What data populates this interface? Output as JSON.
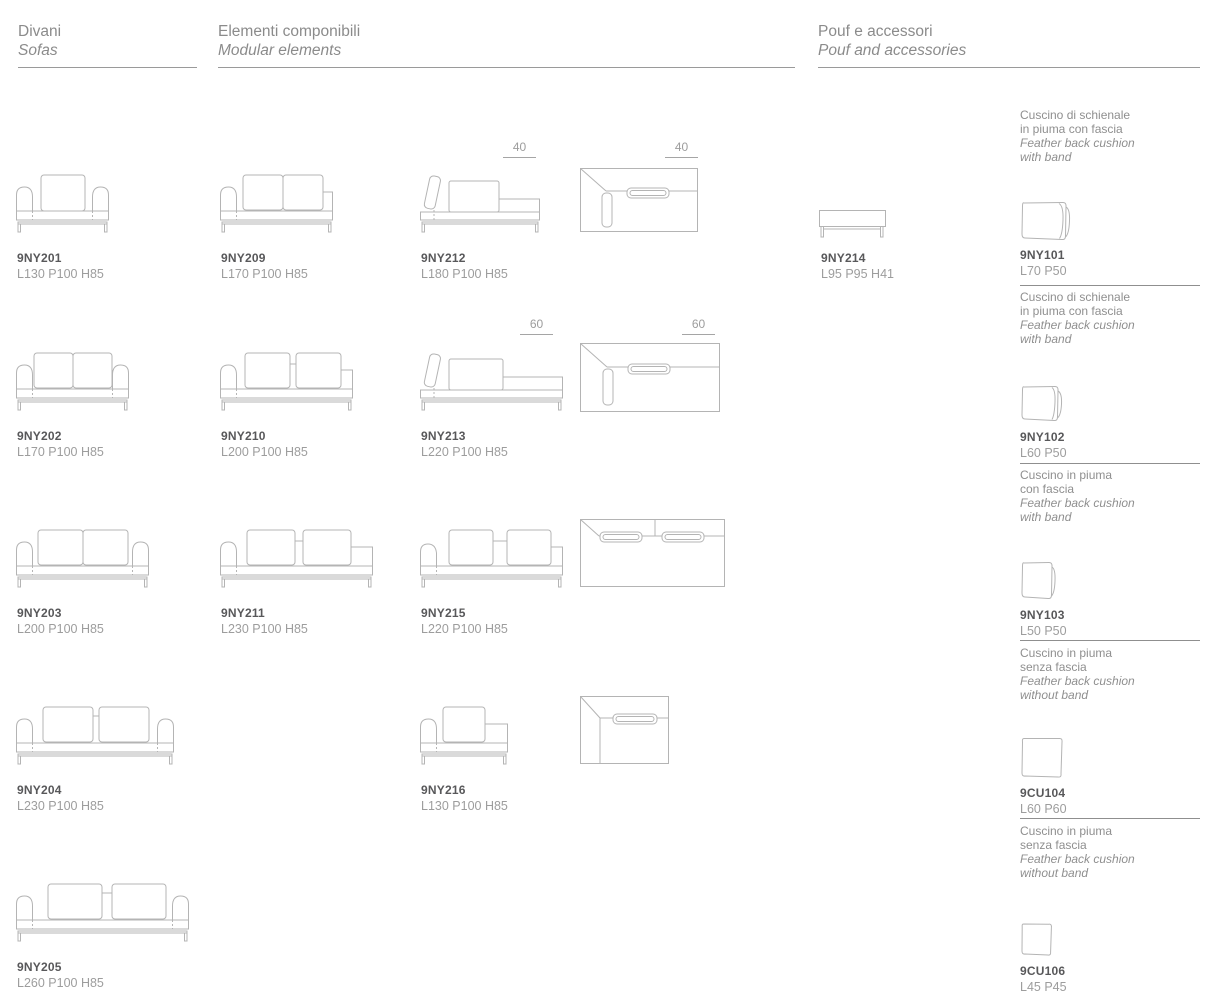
{
  "colors": {
    "line": "#b4b4b4",
    "code_text": "#58585a",
    "dim_text": "#9d9d9d",
    "header_text": "#8b8b8b",
    "rule": "#9a9a9a"
  },
  "headers": {
    "divani": {
      "it": "Divani",
      "en": "Sofas"
    },
    "componibili": {
      "it": "Elementi componibili",
      "en": "Modular elements"
    },
    "pouf": {
      "it": "Pouf e accessori",
      "en": "Pouf and accessories"
    }
  },
  "products": {
    "p9NY201": {
      "code": "9NY201",
      "dims": "L130 P100 H85"
    },
    "p9NY202": {
      "code": "9NY202",
      "dims": "L170 P100 H85"
    },
    "p9NY203": {
      "code": "9NY203",
      "dims": "L200 P100 H85"
    },
    "p9NY204": {
      "code": "9NY204",
      "dims": "L230 P100 H85"
    },
    "p9NY205": {
      "code": "9NY205",
      "dims": "L260 P100 H85"
    },
    "p9NY209": {
      "code": "9NY209",
      "dims": "L170 P100 H85"
    },
    "p9NY210": {
      "code": "9NY210",
      "dims": "L200 P100 H85"
    },
    "p9NY211": {
      "code": "9NY211",
      "dims": "L230 P100 H85"
    },
    "p9NY212": {
      "code": "9NY212",
      "dims": "L180 P100 H85",
      "depth": "40"
    },
    "p9NY213": {
      "code": "9NY213",
      "dims": "L220 P100 H85",
      "depth": "60"
    },
    "p9NY215": {
      "code": "9NY215",
      "dims": "L220 P100 H85"
    },
    "p9NY216": {
      "code": "9NY216",
      "dims": "L130 P100 H85"
    },
    "p9NY214": {
      "code": "9NY214",
      "dims": "L95 P95 H41"
    }
  },
  "accessories": {
    "a9NY101": {
      "it1": "Cuscino di schienale",
      "it2": "in piuma con fascia",
      "en1": "Feather back cushion",
      "en2": "with band",
      "code": "9NY101",
      "dims": "L70 P50"
    },
    "a9NY102": {
      "it1": "Cuscino di schienale",
      "it2": "in piuma con fascia",
      "en1": "Feather back cushion",
      "en2": "with band",
      "code": "9NY102",
      "dims": "L60 P50"
    },
    "a9NY103": {
      "it1": "Cuscino in piuma",
      "it2": "con fascia",
      "en1": "Feather back cushion",
      "en2": "with band",
      "code": "9NY103",
      "dims": "L50 P50"
    },
    "a9CU104": {
      "it1": "Cuscino in piuma",
      "it2": "senza fascia",
      "en1": "Feather back cushion",
      "en2": "without band",
      "code": "9CU104",
      "dims": "L60 P60"
    },
    "a9CU106": {
      "it1": "Cuscino in piuma",
      "it2": "senza fascia",
      "en1": "Feather back cushion",
      "en2": "without band",
      "code": "9CU106",
      "dims": "L45 P45"
    }
  }
}
